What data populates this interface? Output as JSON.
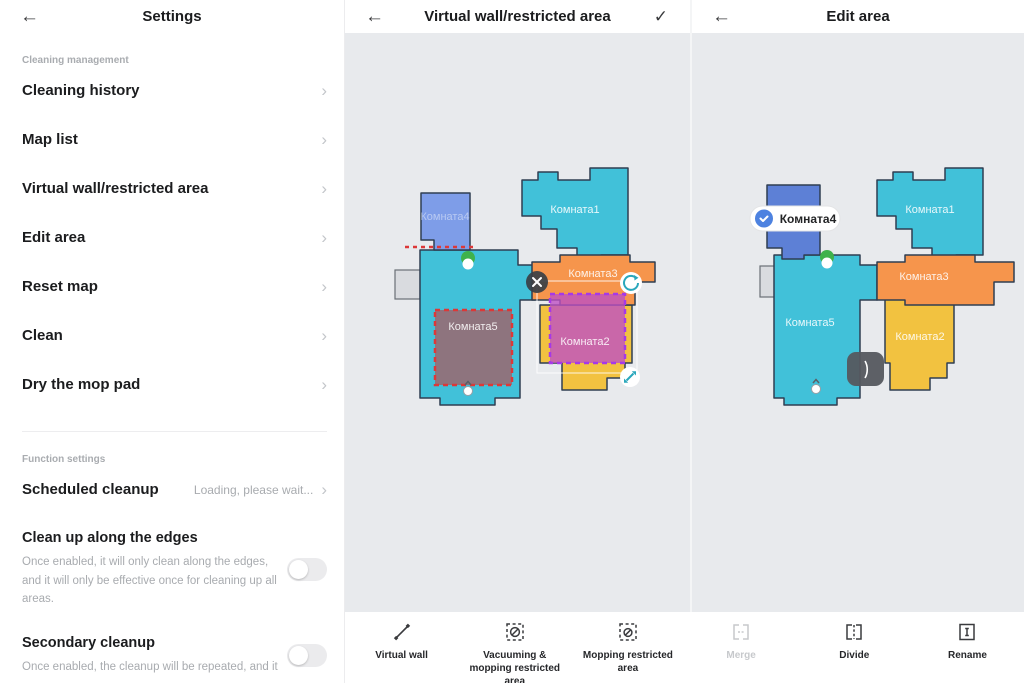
{
  "icons": {
    "back": "←",
    "confirm": "✓",
    "chevron": "›"
  },
  "settings_panel": {
    "title": "Settings",
    "section1": "Cleaning management",
    "items": [
      "Cleaning history",
      "Map list",
      "Virtual wall/restricted area",
      "Edit area",
      "Reset map",
      "Clean",
      "Dry the mop pad"
    ],
    "section2": "Function settings",
    "scheduled": {
      "label": "Scheduled cleanup",
      "value": "Loading, please wait..."
    },
    "edges": {
      "label": "Clean up along the edges",
      "desc": "Once enabled, it will only clean along the edges, and it will only be effective once for cleaning up all areas.",
      "enabled": false
    },
    "secondary": {
      "label": "Secondary cleanup",
      "desc": "Once enabled, the cleanup will be repeated, and it",
      "enabled": false
    }
  },
  "virtual_wall_panel": {
    "title": "Virtual wall/restricted area"
  },
  "edit_area_panel": {
    "title": "Edit area",
    "selected_room_label": "Комната4"
  },
  "rooms": {
    "r1": "Комната1",
    "r2": "Комната2",
    "r3": "Комната3",
    "r4": "Комната4",
    "r5": "Комната5"
  },
  "toolbar": {
    "items": [
      {
        "label": "Virtual wall",
        "enabled": true
      },
      {
        "label": "Vacuuming & mopping restricted area",
        "enabled": true
      },
      {
        "label": "Mopping restricted area",
        "enabled": true
      },
      {
        "label": "Merge",
        "enabled": false
      },
      {
        "label": "Divide",
        "enabled": true
      },
      {
        "label": "Rename",
        "enabled": true
      }
    ]
  },
  "colors": {
    "cyan": "#41c1d9",
    "orange": "#f6954c",
    "yellow": "#f2c240",
    "periwinkle": "#7e9de8",
    "blue": "#5d80d6",
    "red_zone": "#dc3838",
    "purple_zone": "#a638e8",
    "map_bg": "#e8eaed",
    "dock_green": "#3fb24b",
    "accent_teal": "#2aa7bc",
    "check_blue": "#4d82e0"
  }
}
